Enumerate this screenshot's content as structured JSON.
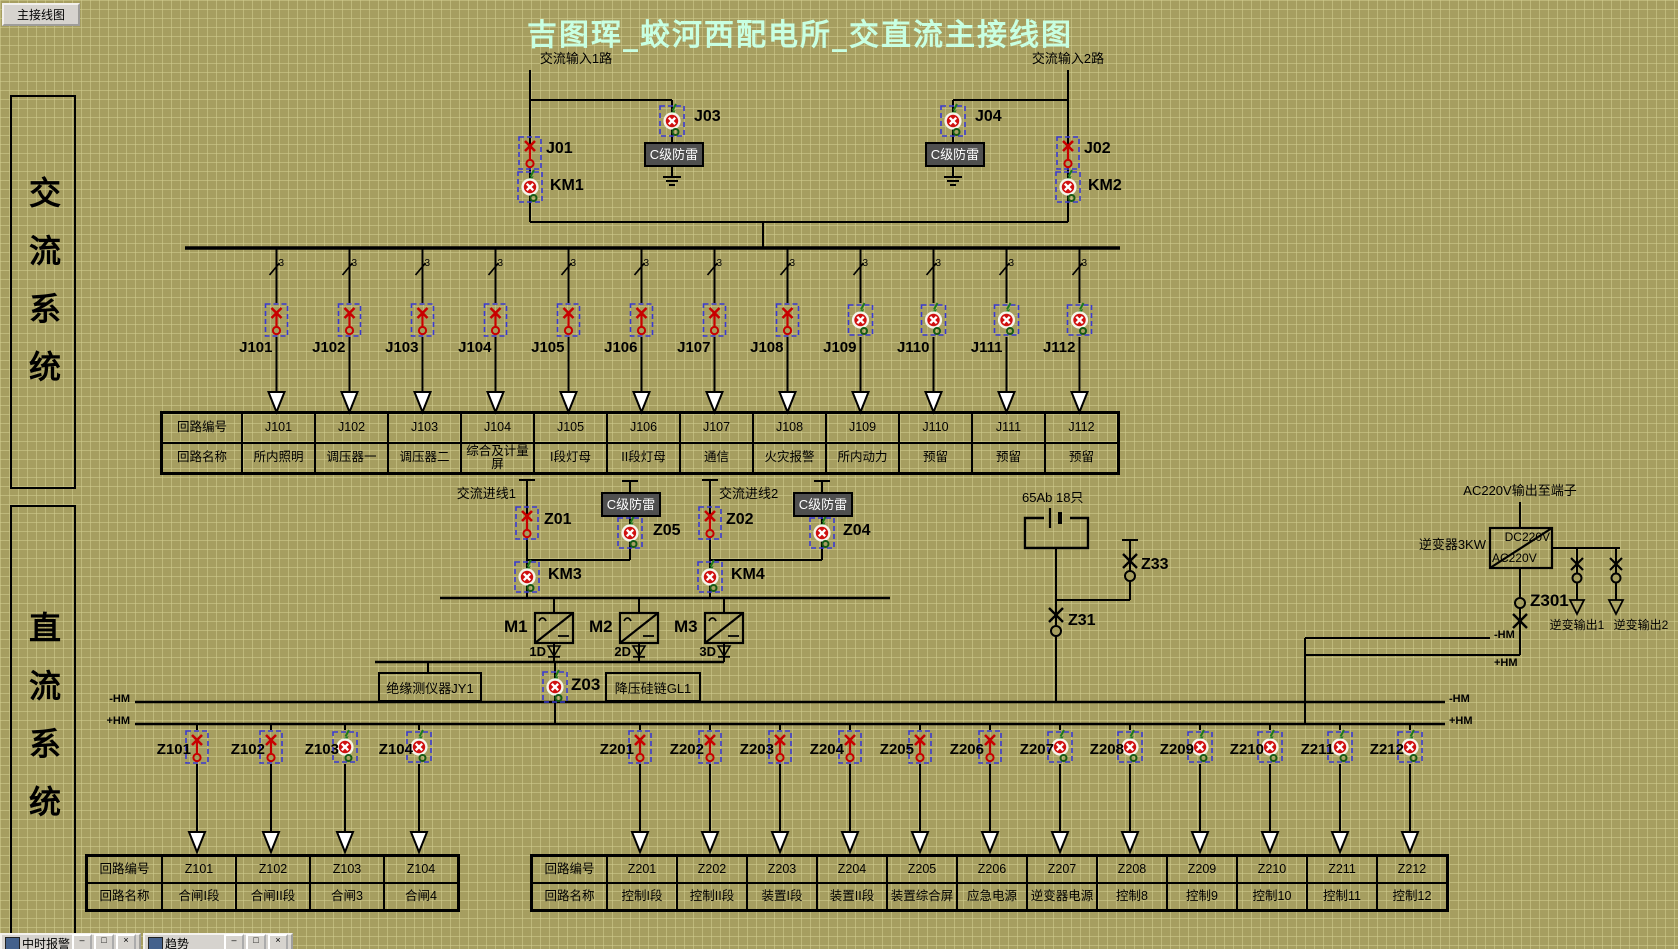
{
  "window": {
    "nav_button": "主接线图",
    "title": "吉图珲_蛟河西配电所_交直流主接线图"
  },
  "sidebar": {
    "ac": "交流系统",
    "dc": "直流系统"
  },
  "colors": {
    "background": "#A69E60",
    "grid_line": "#D2CD91",
    "title_text": "#C8FFE2",
    "switch_open_red": "#C80000",
    "breaker_closed_red": "#D01010",
    "selection_dash_blue": "#3A3AD0",
    "surge_box_bg": "#4F4F4F",
    "button_face": "#D6D3CE"
  },
  "ac_section": {
    "input1": "交流输入1路",
    "input2": "交流输入2路",
    "surge_label": "C级防雷",
    "phase_marker": "3",
    "devices": {
      "j01": "J01",
      "j02": "J02",
      "j03": "J03",
      "j04": "J04",
      "km1": "KM1",
      "km2": "KM2"
    },
    "feeders": [
      {
        "id": "J101",
        "state": "open"
      },
      {
        "id": "J102",
        "state": "open"
      },
      {
        "id": "J103",
        "state": "open"
      },
      {
        "id": "J104",
        "state": "open"
      },
      {
        "id": "J105",
        "state": "open"
      },
      {
        "id": "J106",
        "state": "open"
      },
      {
        "id": "J107",
        "state": "open"
      },
      {
        "id": "J108",
        "state": "open"
      },
      {
        "id": "J109",
        "state": "closed"
      },
      {
        "id": "J110",
        "state": "closed"
      },
      {
        "id": "J111",
        "state": "closed"
      },
      {
        "id": "J112",
        "state": "closed"
      }
    ]
  },
  "j_table": {
    "id_header": "回路编号",
    "name_header": "回路名称",
    "columns": [
      {
        "id": "J101",
        "name": "所内照明"
      },
      {
        "id": "J102",
        "name": "调压器一"
      },
      {
        "id": "J103",
        "name": "调压器二"
      },
      {
        "id": "J104",
        "name": "综合及计量屏"
      },
      {
        "id": "J105",
        "name": "I段灯母"
      },
      {
        "id": "J106",
        "name": "II段灯母"
      },
      {
        "id": "J107",
        "name": "通信"
      },
      {
        "id": "J108",
        "name": "火灾报警"
      },
      {
        "id": "J109",
        "name": "所内动力"
      },
      {
        "id": "J110",
        "name": "预留"
      },
      {
        "id": "J111",
        "name": "预留"
      },
      {
        "id": "J112",
        "name": "预留"
      }
    ]
  },
  "dc_section": {
    "inlet1": "交流进线1",
    "inlet2": "交流进线2",
    "surge_label": "C级防雷",
    "devices": {
      "z01": "Z01",
      "z02": "Z02",
      "z03": "Z03",
      "z04": "Z04",
      "z05": "Z05",
      "km3": "KM3",
      "km4": "KM4",
      "z31": "Z31",
      "z33": "Z33",
      "z301": "Z301"
    },
    "converters": {
      "m1": "M1",
      "m2": "M2",
      "m3": "M3",
      "d1": "1D",
      "d2": "2D",
      "d3": "3D"
    },
    "insulation_box": "绝缘测仪器JY1",
    "silicon_box": "降压硅链GL1",
    "battery_label": "65Ab 18只",
    "inverter": {
      "top_label": "AC220V输出至端子",
      "name": "逆变器3KW",
      "dc": "DC220V",
      "ac": "AC220V",
      "out1": "逆变输出1",
      "out2": "逆变输出2"
    },
    "bus_neg": "-HM",
    "bus_pos": "+HM",
    "left_feeders": [
      {
        "id": "Z101",
        "state": "open"
      },
      {
        "id": "Z102",
        "state": "open"
      },
      {
        "id": "Z103",
        "state": "closed"
      },
      {
        "id": "Z104",
        "state": "closed"
      }
    ],
    "right_feeders": [
      {
        "id": "Z201",
        "state": "open"
      },
      {
        "id": "Z202",
        "state": "open"
      },
      {
        "id": "Z203",
        "state": "open"
      },
      {
        "id": "Z204",
        "state": "open"
      },
      {
        "id": "Z205",
        "state": "open"
      },
      {
        "id": "Z206",
        "state": "open"
      },
      {
        "id": "Z207",
        "state": "closed"
      },
      {
        "id": "Z208",
        "state": "closed"
      },
      {
        "id": "Z209",
        "state": "closed"
      },
      {
        "id": "Z210",
        "state": "closed"
      },
      {
        "id": "Z211",
        "state": "closed"
      },
      {
        "id": "Z212",
        "state": "closed"
      }
    ]
  },
  "z1_table": {
    "id_header": "回路编号",
    "name_header": "回路名称",
    "columns": [
      {
        "id": "Z101",
        "name": "合闸I段"
      },
      {
        "id": "Z102",
        "name": "合闸II段"
      },
      {
        "id": "Z103",
        "name": "合闸3"
      },
      {
        "id": "Z104",
        "name": "合闸4"
      }
    ]
  },
  "z2_table": {
    "id_header": "回路编号",
    "name_header": "回路名称",
    "columns": [
      {
        "id": "Z201",
        "name": "控制I段"
      },
      {
        "id": "Z202",
        "name": "控制II段"
      },
      {
        "id": "Z203",
        "name": "装置I段"
      },
      {
        "id": "Z204",
        "name": "装置II段"
      },
      {
        "id": "Z205",
        "name": "装置综合屏"
      },
      {
        "id": "Z206",
        "name": "应急电源"
      },
      {
        "id": "Z207",
        "name": "逆变器电源"
      },
      {
        "id": "Z208",
        "name": "控制8"
      },
      {
        "id": "Z209",
        "name": "控制9"
      },
      {
        "id": "Z210",
        "name": "控制10"
      },
      {
        "id": "Z211",
        "name": "控制11"
      },
      {
        "id": "Z212",
        "name": "控制12"
      }
    ]
  },
  "taskbar": {
    "windows": [
      {
        "label": "中时报警"
      },
      {
        "label": "趋势"
      }
    ],
    "button_glyphs": {
      "minimize": "–",
      "restore": "□",
      "close": "×"
    }
  }
}
